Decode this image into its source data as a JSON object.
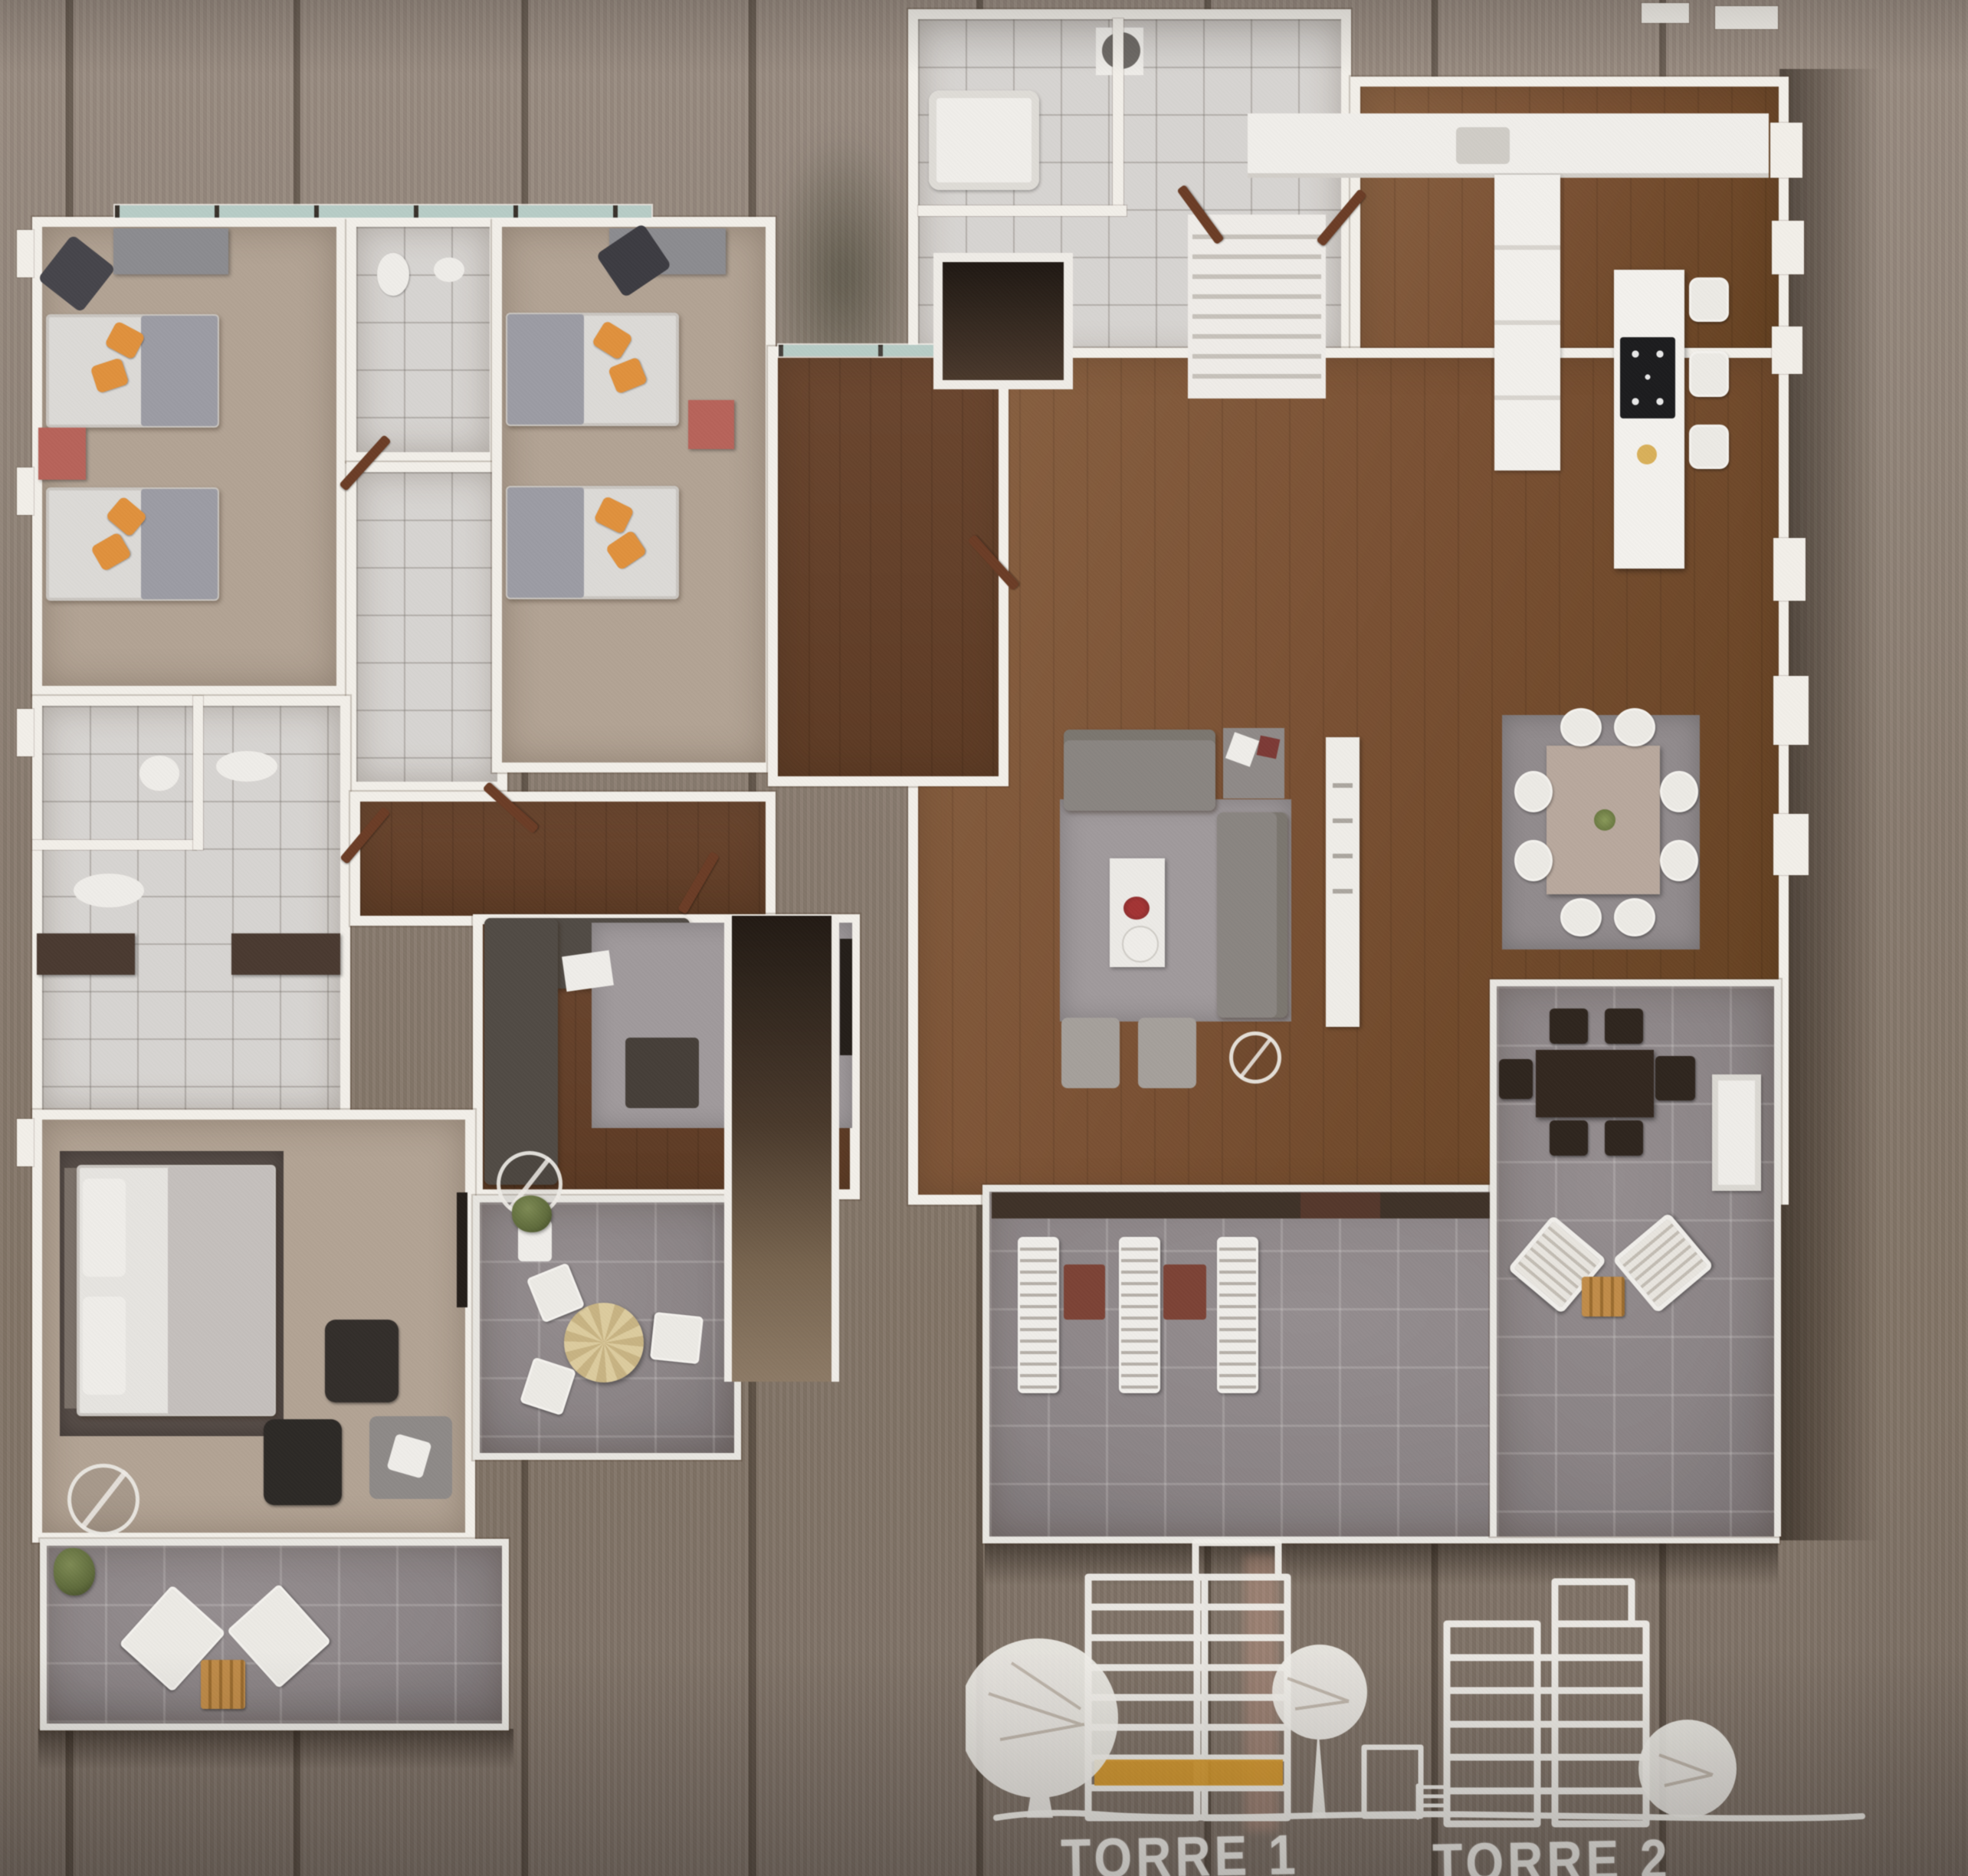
{
  "labels": {
    "tower1": "TORRE 1",
    "tower2": "TORRE 2"
  },
  "sketch": {
    "tower1_floors": 8,
    "tower2_floors": 6,
    "highlighted_tower": "TORRE 1",
    "highlighted_level_from_bottom": 2
  },
  "colors": {
    "wall": "#f2efe9",
    "glass": "#b7ccc6",
    "floor_wood": "#7a5134",
    "floor_tan": "#b2a394",
    "tile_light": "#d7d4d1",
    "terrace_tile": "#8b8486",
    "rug_gray": "#a09a9c",
    "rug_dark": "#574d48",
    "sofa_gray": "#8a8581",
    "sofa_dark": "#514b45",
    "pillow_orange": "#e0913d",
    "nightstand_red": "#b7635a",
    "door_brown": "#6b3d26",
    "dark_wood_furn": "#33271f",
    "lounger_table_red": "#7c4336",
    "tan_table": "#c08c49",
    "plant_green": "#5f6b3c",
    "sketch_line": "#f0eee9",
    "highlight_orange": "#d89b2e"
  }
}
